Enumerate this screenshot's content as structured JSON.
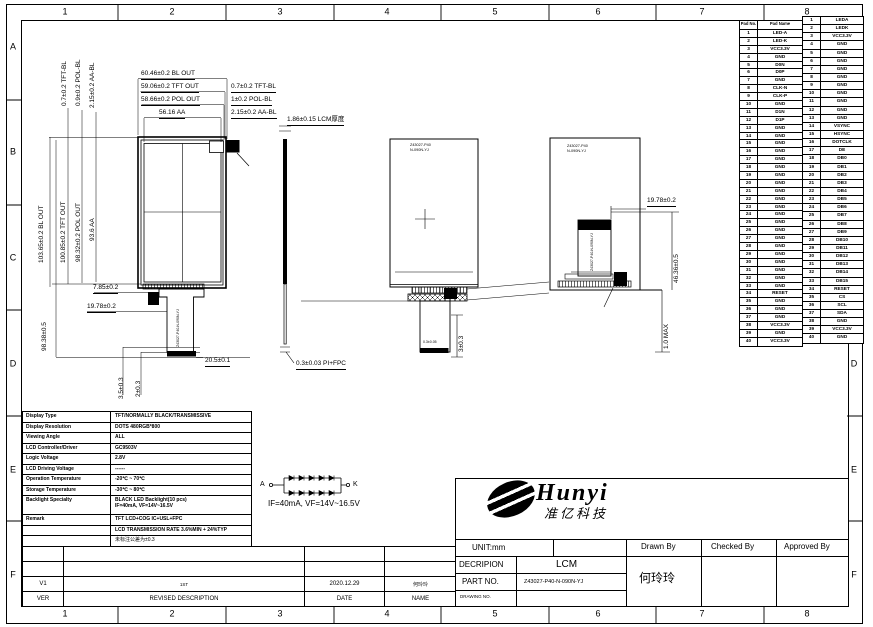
{
  "sheet": {
    "grid_cols": [
      "1",
      "2",
      "3",
      "4",
      "5",
      "6",
      "7",
      "8"
    ],
    "grid_rows": [
      "A",
      "B",
      "C",
      "D",
      "E",
      "F"
    ],
    "line_color": "#000000",
    "paper_color": "#ffffff"
  },
  "dims": {
    "w_bl": "60.46±0.2 BL OUT",
    "w_tft": "59.06±0.2 TFT OUT",
    "w_pol": "58.66±0.2 POL OUT",
    "w_aa": "56.16 AA",
    "g_tft_r": "0.7±0.2  TFT-BL",
    "g_pol_r": "1±0.2 POL-BL",
    "g_aa_r": "2.15±0.2  AA-BL",
    "thickness": "1.86±0.15 LCM厚度",
    "g_tft_t": "0.7±0.2 TFT-BL",
    "g_pol_t": "0.9±0.2 POL-BL",
    "g_aa_t": "2.15±0.2 AA-BL",
    "h_bl": "103.65±0.2 BL OUT",
    "h_tft": "100.85±0.2 TFT OUT",
    "h_pol": "98.32±0.2 POL OUT",
    "h_aa": "93.6 AA",
    "h_module": "98.38±0.5",
    "off_x": "7.85±0.2",
    "off_tail": "19.78±0.2",
    "t_35": "3.5±0.3",
    "t_2": "2±0.3",
    "tail_w": "20.5±0.1",
    "pi_fpc": "0.3±0.03 PI+FPC",
    "t_3": "3±0.3",
    "tail_tol": "0.3±0.05",
    "off_tail_b": "19.78±0.2",
    "fpc_len": "46.36±0.5",
    "gap_max": "1.0 MAX"
  },
  "panel_print": {
    "line1": "Z43027-P40",
    "line2": "N-090N-YJ",
    "vertical": "Z43027-P40-N-090N-YJ"
  },
  "led_circuit": {
    "anode": "A",
    "cathode": "K",
    "spec": "IF=40mA, VF=14V~16.5V"
  },
  "spec_table": {
    "rows": [
      {
        "label": "Display Type",
        "value": "TFT/NORMALLY BLACK/TRANSMISSIVE"
      },
      {
        "label": "Display Resolution",
        "value": "DOTS 480RGB*800"
      },
      {
        "label": "Viewing Angle",
        "value": "ALL"
      },
      {
        "label": "LCD Controller/Driver",
        "value": "GC9503V"
      },
      {
        "label": "Logic Voltage",
        "value": "2.8V"
      },
      {
        "label": "LCD Driving Voltage",
        "value": "------"
      },
      {
        "label": "Operation Temperature",
        "value": "-20℃ ~ 70℃"
      },
      {
        "label": "Storage Temperature",
        "value": "-30℃ ~ 80℃"
      },
      {
        "label": "Backlight Specialty",
        "value": "BLACK LED Backlight(10 pcs)\nIF=40mA, VF=14V~16.5V"
      },
      {
        "label": "Remark",
        "value": "TFT LCD+COG IC+USL+FPC"
      },
      {
        "label": "",
        "value": "LCD TRANSMISSION RATE    3.6%MIN + 24%TYP"
      },
      {
        "label": "",
        "value": "未标注公差为±0.3"
      }
    ]
  },
  "pin_table_left": {
    "header_no": "Pad No.",
    "header_name": "Pad Name",
    "pins": [
      "LED-A",
      "LED-K",
      "VCC3.3V",
      "GND",
      "D0N",
      "D0P",
      "GND",
      "CLK-N",
      "CLK-P",
      "GND",
      "D1N",
      "D1P",
      "GND",
      "GND",
      "GND",
      "GND",
      "GND",
      "GND",
      "GND",
      "GND",
      "GND",
      "GND",
      "GND",
      "GND",
      "GND",
      "GND",
      "GND",
      "GND",
      "GND",
      "GND",
      "GND",
      "GND",
      "GND",
      "RESET",
      "GND",
      "GND",
      "GND",
      "VCC3.3V",
      "GND",
      "VCC3.3V"
    ]
  },
  "pin_table_right": {
    "pins": [
      "LEDA",
      "LEDK",
      "VCC3.3V",
      "GND",
      "GND",
      "GND",
      "GND",
      "GND",
      "GND",
      "GND",
      "GND",
      "GND",
      "GND",
      "VSYNC",
      "HSYNC",
      "DOTCLK",
      "DE",
      "DB0",
      "DB1",
      "DB2",
      "DB3",
      "DB4",
      "DB5",
      "DB6",
      "DB7",
      "DB8",
      "DB9",
      "DB10",
      "DB11",
      "DB12",
      "DB13",
      "DB14",
      "DB15",
      "RESET",
      "CS",
      "SCL",
      "SDA",
      "GND",
      "VCC3.3V",
      "GND"
    ]
  },
  "revision_table": {
    "header": {
      "ver": "VER",
      "desc": "REVISED DESCRIPTION",
      "date": "DATE",
      "name": "NAME"
    },
    "entry": {
      "ver": "V1",
      "desc": "1ST",
      "date": "2020.12.29",
      "name": "何玲玲"
    }
  },
  "title_block": {
    "logo_text": "Hunyi",
    "logo_cn": "准亿科技",
    "unit_label": "UNIT:mm",
    "drawn_by_label": "Drawn By",
    "checked_by_label": "Checked By",
    "approved_by_label": "Approved By",
    "decription_label": "DECRIPION",
    "decription_value": "LCM",
    "part_no_label": "PART NO.",
    "part_no_value": "Z43027-P40-N-090N-YJ",
    "drawing_no_label": "DRAWING NO.",
    "drawn_by_value": "何玲玲"
  }
}
